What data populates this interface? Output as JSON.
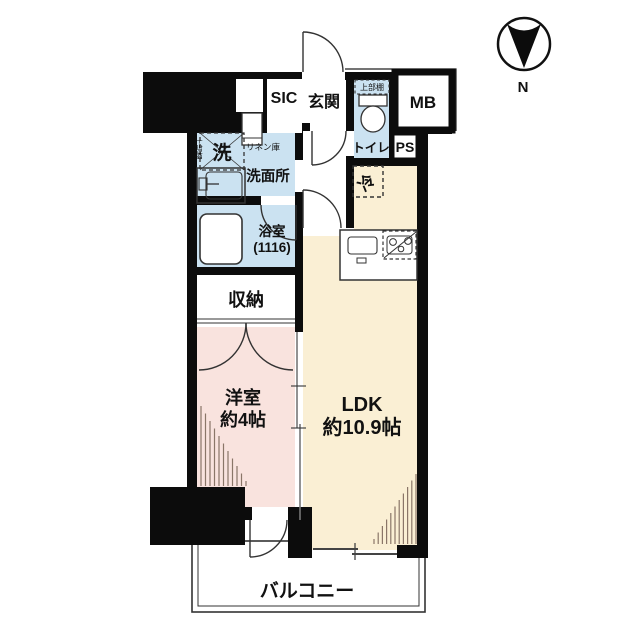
{
  "plan": {
    "compass_label": "N",
    "rooms": {
      "sic": "SIC",
      "entrance": "玄関",
      "meter_box": "MB",
      "toilet": "トイレ",
      "pipe_space": "PS",
      "washroom": "洗面所",
      "linen_closet": "リネン庫",
      "washer": "洗",
      "washer_shelf": "上部棚",
      "toilet_shelf": "上部棚",
      "bathroom_name": "浴室",
      "bathroom_size": "(1116)",
      "storage": "収納",
      "bedroom_name": "洋室",
      "bedroom_size": "約4帖",
      "ldk_name": "LDK",
      "ldk_size": "約10.9帖",
      "fridge": "冷",
      "balcony": "バルコニー"
    },
    "colors": {
      "wall": "#0c0c0c",
      "wet_area": "#cbe2f1",
      "ldk_area": "#faefd4",
      "bedroom_area": "#f9e3de",
      "hatch": "#8a7668",
      "line": "#333333"
    }
  }
}
